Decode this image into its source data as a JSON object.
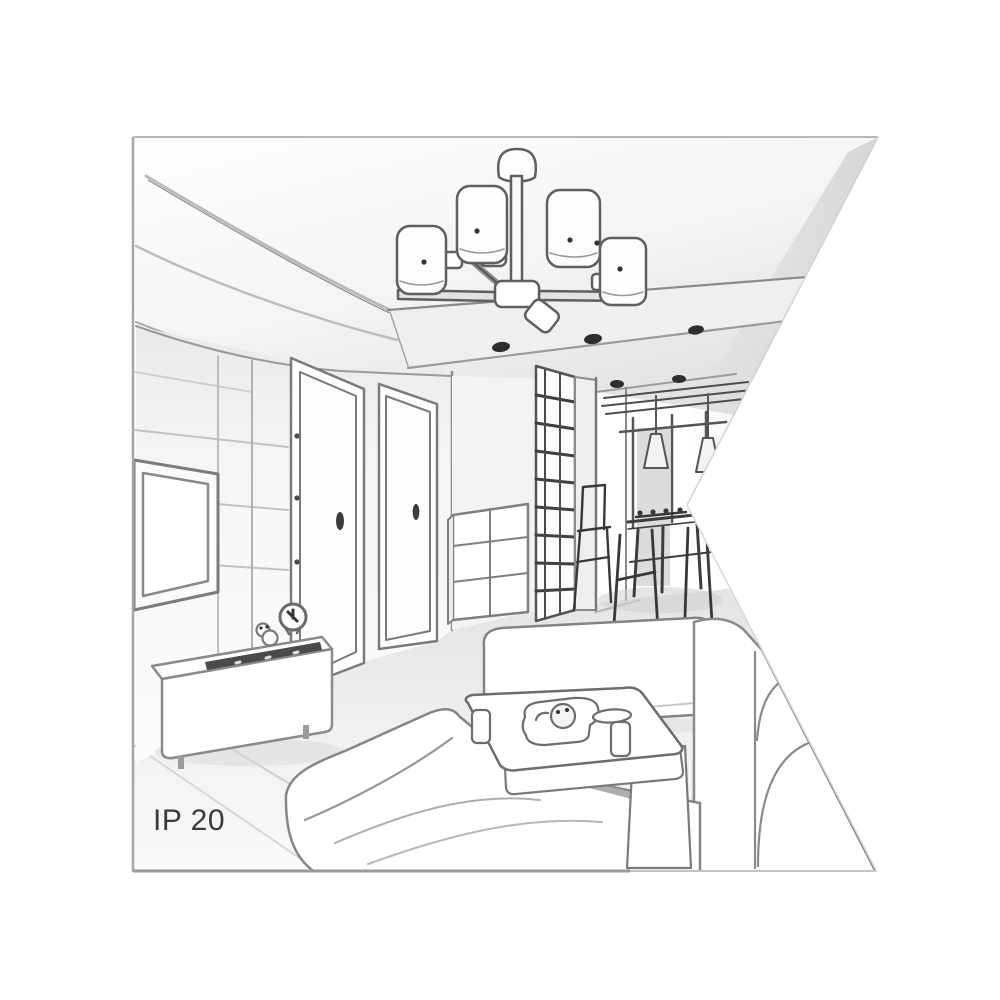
{
  "illustration": {
    "kind": "interior-room-line-drawing",
    "protection_rating_label": "IP 20",
    "palette": {
      "background": "#ffffff",
      "outline": "#6f6f6f",
      "outline_dark": "#3a3a3a",
      "shade_light": "#ececec",
      "shade_mid": "#dcdcdc",
      "shade_deep": "#c9c9c9",
      "label_color": "#3b3b3b",
      "frame_border": "#a6a6a6"
    },
    "elements": [
      "five-shade-ceiling-chandelier",
      "tray-ceiling-recessed-spotlights",
      "hallway-downlights",
      "wall-mounted-tv",
      "paneled-tv-wall",
      "media-sideboard",
      "alarm-clock",
      "figurine",
      "soundbar-remote",
      "interior-door-left",
      "interior-door-right",
      "slatted-wardrobe",
      "chest-of-drawers",
      "dining-table",
      "dining-chairs",
      "cone-pendant-lights",
      "window-pier",
      "corner-sofa",
      "bench-sofa",
      "right-sofa",
      "coffee-table",
      "teapot",
      "cups",
      "serving-dish",
      "area-rug"
    ]
  }
}
